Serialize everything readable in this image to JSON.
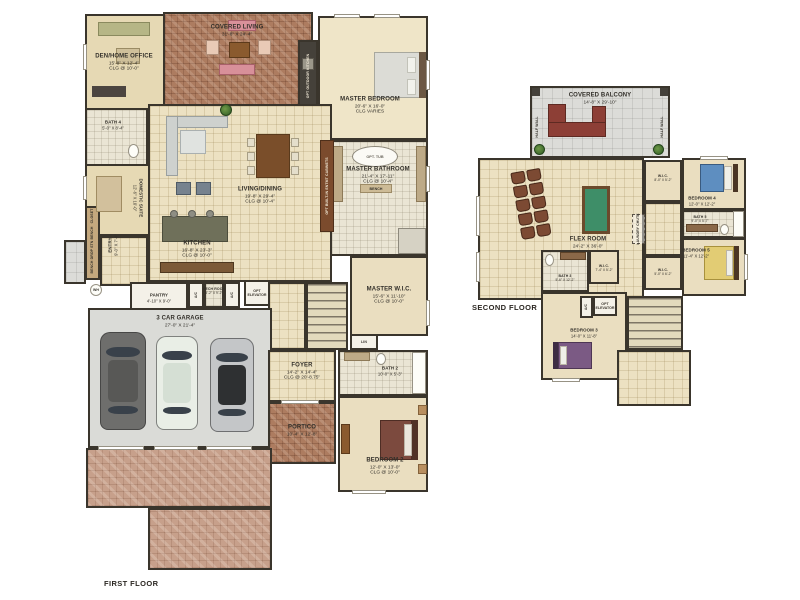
{
  "page": {
    "first_floor_label": "FIRST FLOOR",
    "second_floor_label": "SECOND FLOOR"
  },
  "first_floor": {
    "den": {
      "name": "DEN/HOME OFFICE",
      "dims": "15'-8\" X 12'-4\"",
      "clg": "CLG @ 10'-0\""
    },
    "covered_living": {
      "name": "COVERED LIVING",
      "dims": "31'-8\" X 24'-4\""
    },
    "opt_outdoor_kitchen": "OPT OUTDOOR KITCHEN",
    "master_bedroom": {
      "name": "MASTER BEDROOM",
      "dims": "20'-6\" X 16'-0\"",
      "clg": "CLG VARIES"
    },
    "bath4": {
      "name": "BATH 4",
      "dims": "5'-0\" X 8'-4\""
    },
    "domestic_suite": {
      "name": "DOMESTIC SUITE",
      "dims": "12'-6\" X 10'-0\""
    },
    "living_dining": {
      "name": "LIVING/DINING",
      "dims": "19'-8\" X 29'-4\"",
      "clg": "CLG @ 10'-4\""
    },
    "master_bathroom": {
      "name": "MASTER BATHROOM",
      "dims": "21'-4\" X 17'-11\"",
      "clg": "CLG @ 10'-4\""
    },
    "opt_tub": "OPT. TUB",
    "bench_label": "BENCH",
    "entmt_cabinets": "OPT BUILT-IN ENTMT CABINETS",
    "kitchen": {
      "name": "KITCHEN",
      "dims": "16'-8\" X 23'-3\"",
      "clg": "CLG @ 10'-0\""
    },
    "entry": {
      "name": "ENTRY",
      "dims": "9'-0\" X 7'-4\""
    },
    "closet": "CLOSET",
    "bench1": "BENCH",
    "drop_station": "DROP STN",
    "bench2": "BENCH",
    "wh": "WH",
    "pantry": {
      "name": "PANTRY",
      "dims": "4'-10\" X 9'-0\""
    },
    "ac": "A/C",
    "mech_room": {
      "name": "MECH ROOM",
      "dims": "4'-2\" X 9'-2\""
    },
    "opt_elevator": "OPT ELEVATOR",
    "garage": {
      "name": "3 CAR GARAGE",
      "dims": "27'-0\" X 21'-4\""
    },
    "master_wic": {
      "name": "MASTER W.I.C.",
      "dims": "15'-6\" X 11'-10\"",
      "clg": "CLG @ 10'-0\""
    },
    "lin": "LIN",
    "foyer": {
      "name": "FOYER",
      "dims": "14'-2\" X 14'-4\"",
      "clg": "CLG @ 20'-8.75\""
    },
    "bath2": {
      "name": "BATH 2",
      "dims": "10'-0\" X 5'-3\""
    },
    "portico": {
      "name": "PORTICO",
      "dims": "10'-4\" X 12'-8\""
    },
    "bedroom2": {
      "name": "BEDROOM 2",
      "dims": "12'-0\" X 13'-0\"",
      "clg": "CLG @ 10'-0\""
    }
  },
  "second_floor": {
    "covered_balcony": {
      "name": "COVERED BALCONY",
      "dims": "14'-8\" X 29'-10\""
    },
    "half_wall": "HALF WALL",
    "flex_room": {
      "name": "FLEX ROOM",
      "dims": "24'-2\" X 36'-0\""
    },
    "wic4": {
      "name": "W.I.C.",
      "dims": "8'-0\" X 5'-2\""
    },
    "bedroom4": {
      "name": "BEDROOM 4",
      "dims": "12'-0\" X 12'-2\""
    },
    "bath5": {
      "name": "BATH 5",
      "dims": "9'-0\" X 5'-7\""
    },
    "bedroom5": {
      "name": "BEDROOM 5",
      "dims": "11'-4\" X 12'-2\""
    },
    "wic5": {
      "name": "W.I.C.",
      "dims": "5'-0\" X 6'-2\""
    },
    "laundry_chute": "LAUNDRY CHUTE",
    "bath3": {
      "name": "BATH 3",
      "dims": "5'-6\" X 12'-2\""
    },
    "wic3": {
      "name": "W.I.C.",
      "dims": "7'-4\" X 5'-2\""
    },
    "ac": "A/C",
    "opt_elevator": "OPT ELEVATOR",
    "bedroom3": {
      "name": "BEDROOM 3",
      "dims": "14'-0\" X 11'-8\""
    }
  }
}
